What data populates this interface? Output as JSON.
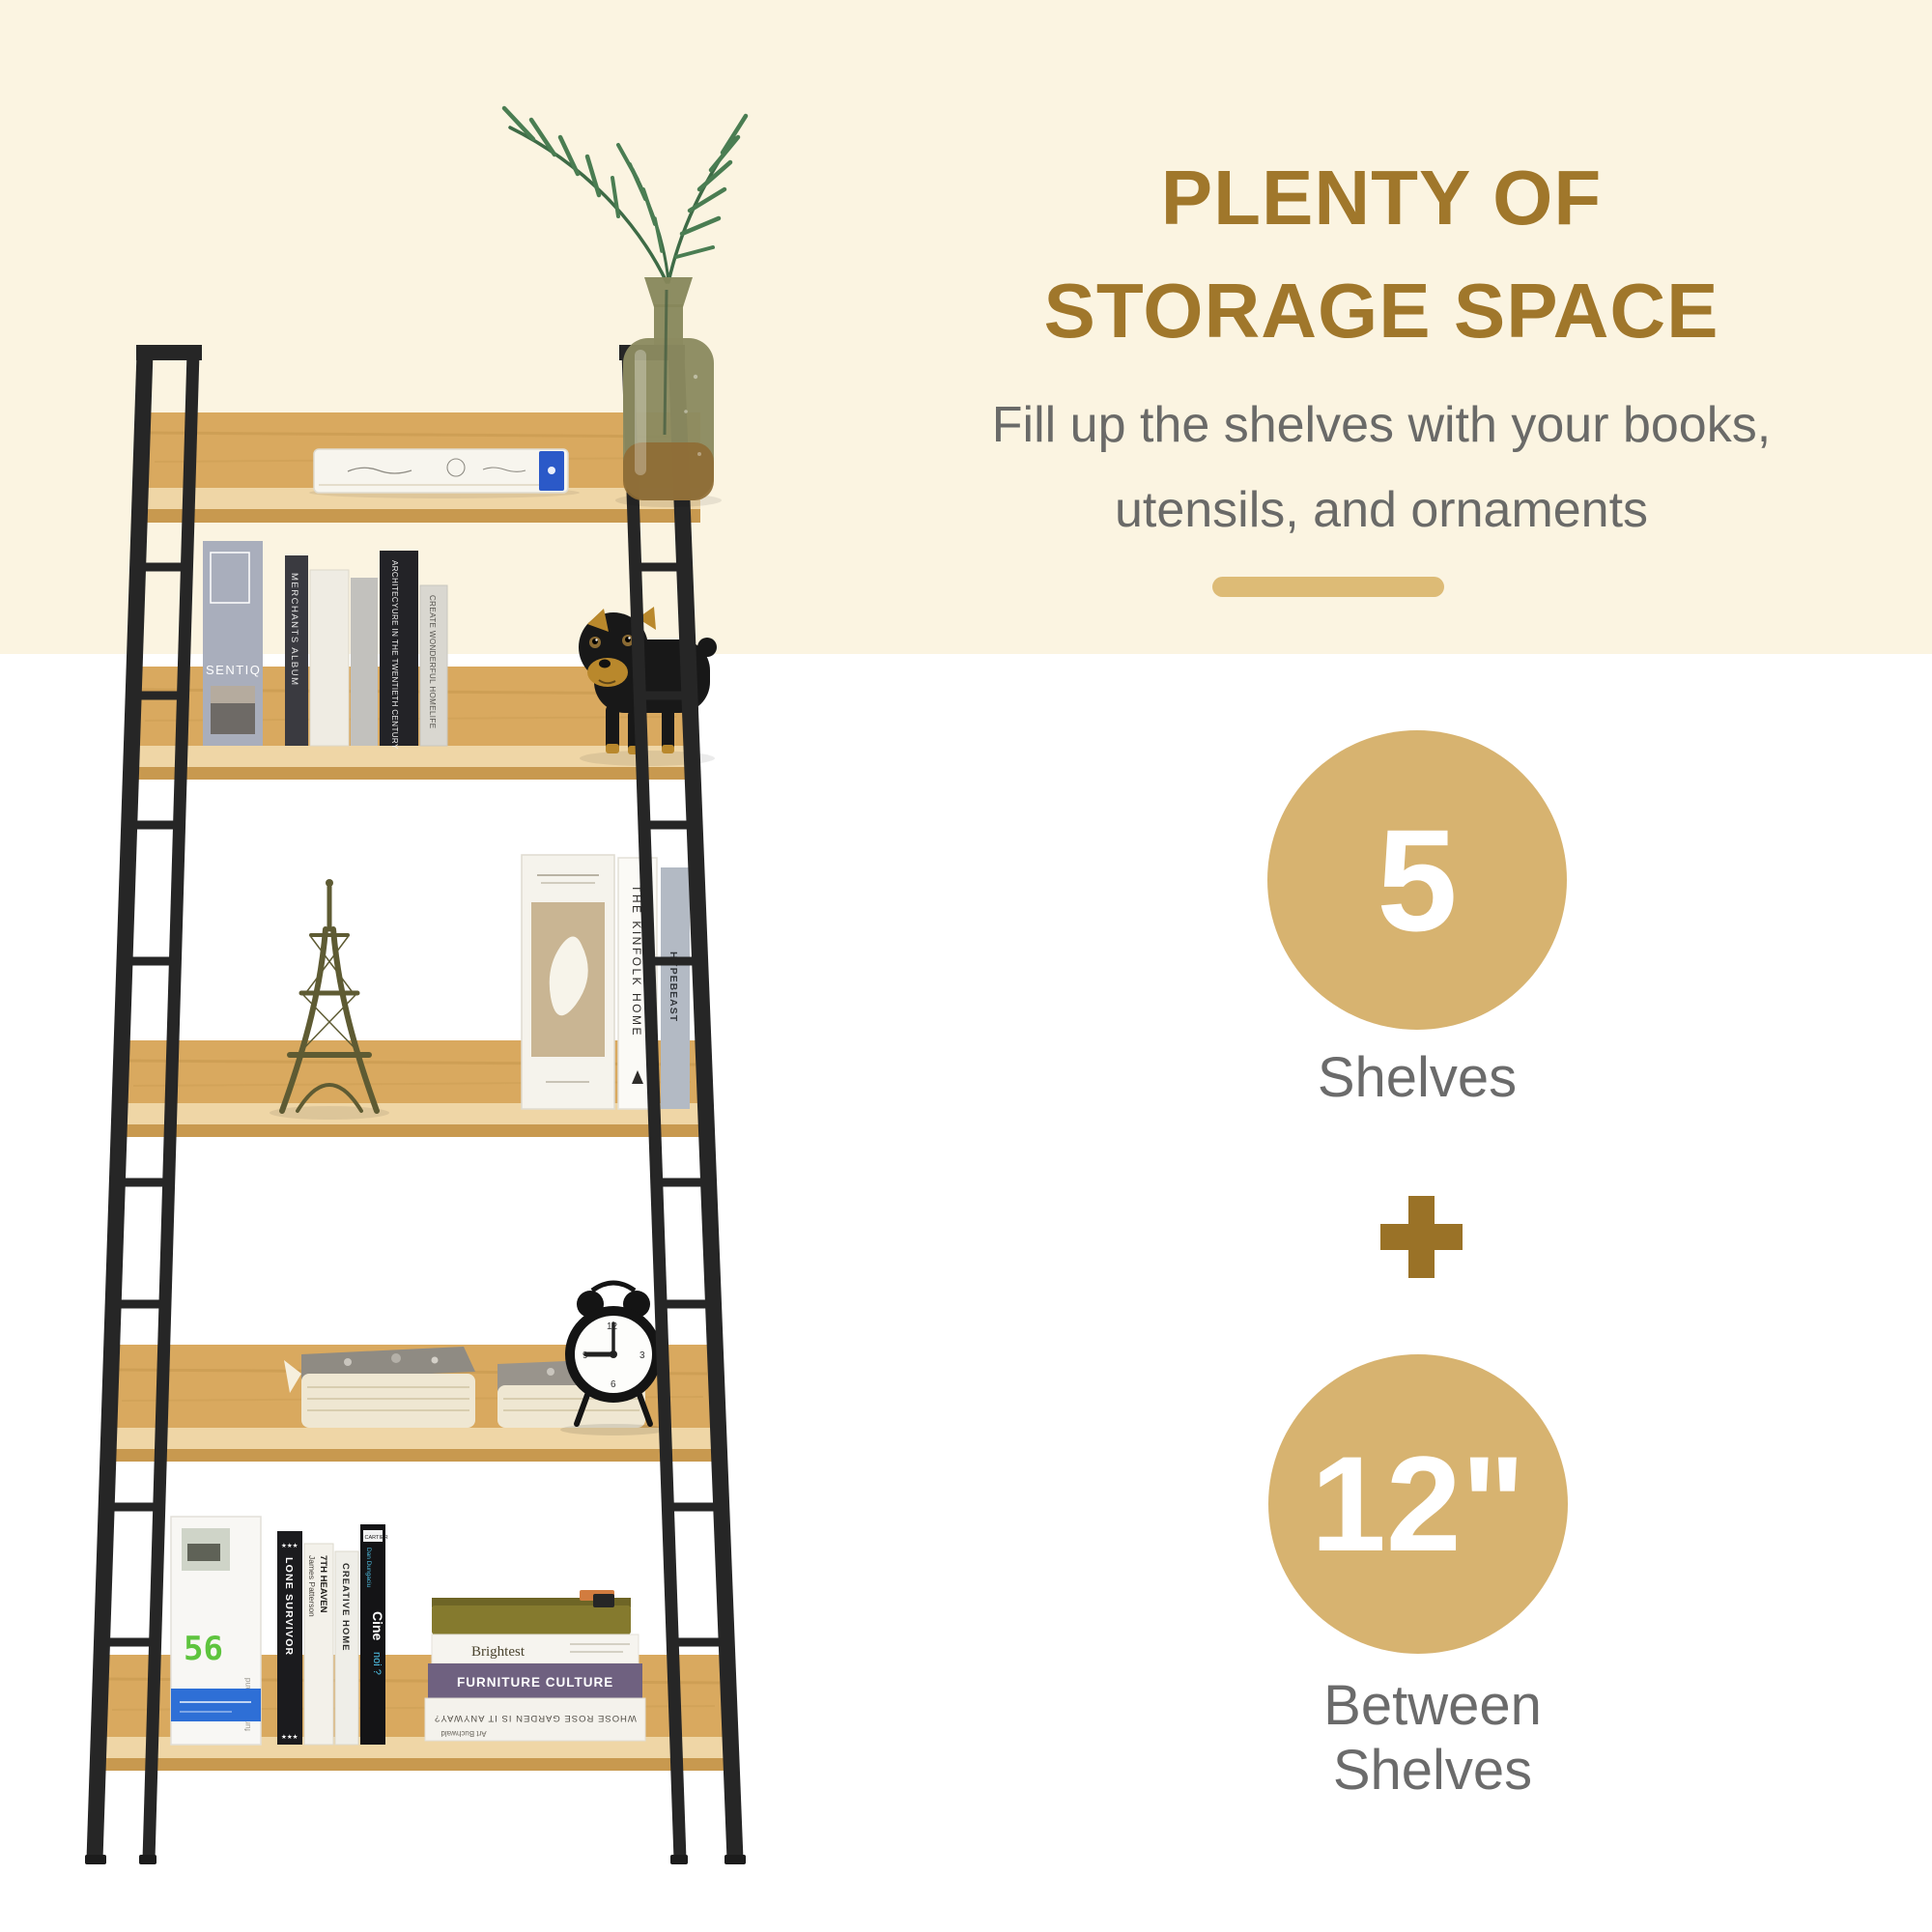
{
  "page": {
    "bg_top_color": "#fbf4e1",
    "bg_bottom_color": "#ffffff"
  },
  "right_panel": {
    "title": {
      "line1": "PLENTY OF",
      "line2": "STORAGE SPACE",
      "color": "#a0772b"
    },
    "subtitle": {
      "line1": "Fill up the shelves with your books,",
      "line2": "utensils, and ornaments",
      "color": "#6a6a68"
    },
    "divider_color": "#ddbb76",
    "stats": [
      {
        "value": "5",
        "label": "Shelves"
      },
      {
        "value": "12\"",
        "label": "Between Shelves"
      }
    ],
    "plus_icon": "plus-icon",
    "circle_color": "#d7b370",
    "value_color": "#ffffff",
    "label_color": "#6b6b6b",
    "plus_color": "#9a7227"
  },
  "photo": {
    "subject": "5-tier ladder bookshelf, black steel frame, oak-look shelves",
    "frame_color": "#262626",
    "wood_lip_color": "#d9a95f",
    "wood_top_color": "#efd6a6",
    "wood_edge_color": "#c8994f",
    "books": {
      "sentiq": "SENTIQ",
      "merchants_album": "MERCHANTS ALBUM",
      "architecture": "ARCHITECYURE IN THE TWENTIETH CENTURY",
      "create_wonderful": "CREATE WONDERFUL HOMELIFE",
      "kinfolk": "THE KINFOLK HOME",
      "hypebeast": "HYPEBEAST",
      "lone_survivor": "LONE SURVIVOR",
      "stars": "★★★",
      "james_patterson": "James Patterson",
      "seventh_heaven": "7TH HEAVEN",
      "creative_home": "CREATIVE HOME",
      "cartier": "CARTIER",
      "dan_dungaciu": "Dan Dungaciu",
      "cine": "Cine",
      "noi": "noi ?",
      "brightest": "Brightest",
      "furniture_culture": "FURNITURE CULTURE",
      "whose_rose": "WHOSE ROSE GARDEN IS IT ANYWAY?",
      "art_buchwald": "Art Buchwald",
      "led_number": "56",
      "furniture_brand": "furniture brand"
    }
  }
}
